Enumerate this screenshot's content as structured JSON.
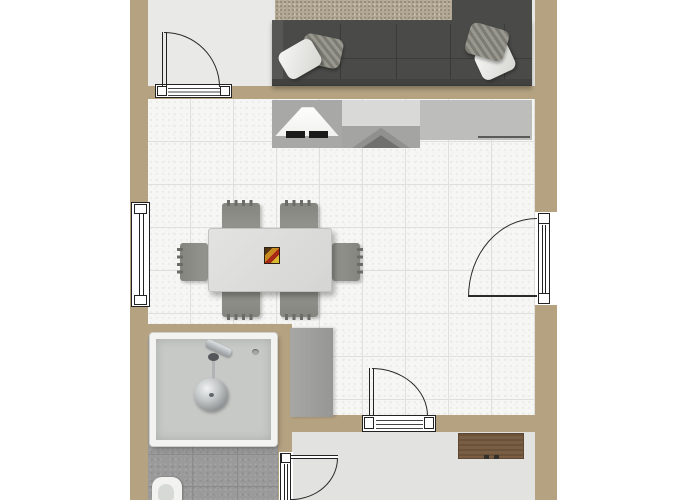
{
  "canvas": {
    "width": 700,
    "height": 500,
    "background": "#ffffff"
  },
  "plan": {
    "name": "apartment floor plan (3D top-down render, no text labels)",
    "colors": {
      "wall": "#b4a280",
      "tile_floor": "#f6f6f4",
      "tile_grout": "#dfdfdd",
      "entry_floor": "#e9e9e7",
      "living_floor": "#e7e7e5",
      "hall_floor": "#e2e2e0",
      "bath_stone": "#9a9a9a",
      "stone_joint": "#8a8a8a",
      "sofa": "#4a4a48",
      "rug": "#b1a794",
      "media_unit_left": "#a8a8a6",
      "media_unit_middle": "#d9d9d7",
      "media_unit_right": "#bdbdbb",
      "table": "#dcdcda",
      "chair": "#8c8c88",
      "cabinet": "#a0a09e",
      "bench_wood": "#7a5e43",
      "basin_rim": "#f3f3f1",
      "basin": "#c7c9c7",
      "toilet": "#f2f2f0",
      "symbol_line": "#222222"
    },
    "rooms": {
      "lounge": {
        "name": "lounge with corner sofa and rug"
      },
      "entry": {
        "name": "entry area"
      },
      "main_room": {
        "name": "tiled living-dining room"
      },
      "bathroom": {
        "name": "bathroom with stone floor"
      },
      "hallway": {
        "name": "hallway"
      }
    },
    "furniture": {
      "sofa": {
        "name": "dark grey corner sectional sofa",
        "pillow_count": 4
      },
      "rug": {
        "name": "textured beige area rug"
      },
      "media_unit": {
        "name": "media wall unit with tv and pyramid object"
      },
      "dining_table": {
        "name": "rectangular dining table",
        "chair_count": 6
      },
      "chair": {
        "name": "fringed dining chair"
      },
      "centerpiece": {
        "name": "colorful table centerpiece"
      },
      "cabinet": {
        "name": "grey cabinet"
      },
      "bench": {
        "name": "wooden sideboard bench",
        "knob_count": 2
      },
      "basin": {
        "name": "square utility basin with faucet and round drain"
      },
      "toilet": {
        "name": "toilet (partially cropped)"
      }
    },
    "openings": {
      "window_left": {
        "name": "window in left exterior wall"
      },
      "door_top": {
        "name": "swing door between entry and main room"
      },
      "door_right": {
        "name": "swing door in right exterior wall"
      },
      "door_bottom": {
        "name": "swing door between main room and hallway"
      },
      "door_bath": {
        "name": "swing door between bathroom and hallway"
      }
    }
  }
}
